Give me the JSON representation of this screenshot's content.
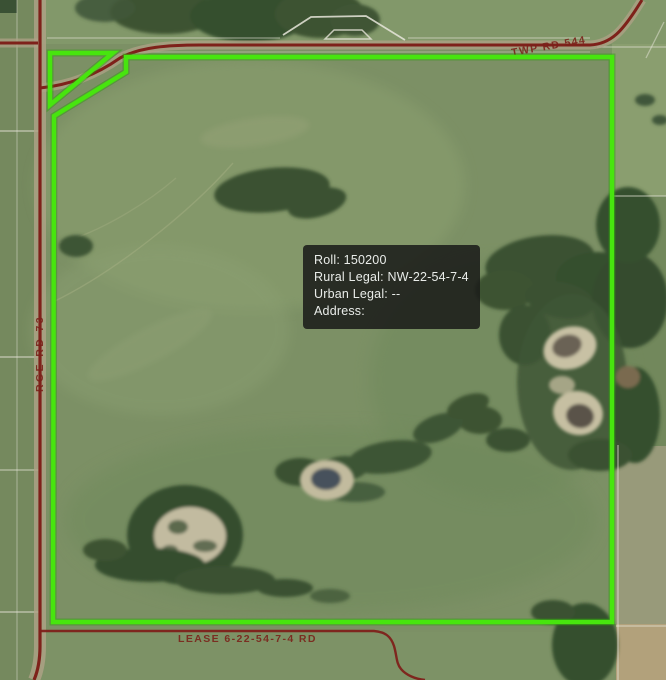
{
  "colors": {
    "parcel_outline": "#47E50E",
    "road_line": "#7E211A",
    "road_label_text": "#7A2019",
    "field_line": "#E8E6DB",
    "tooltip_background": "rgba(26,28,25,0.87)",
    "tooltip_text": "#E9ECE9"
  },
  "road_labels": {
    "top_township_road": "TWP RD 544",
    "left_range_road": "RGE RD 73",
    "bottom_lease_road": "LEASE 6-22-54-7-4 RD"
  },
  "parcel_tooltip": {
    "lines": [
      "Roll: 150200",
      "Rural Legal: NW-22-54-7-4",
      "Urban Legal: --",
      "Address:"
    ]
  }
}
